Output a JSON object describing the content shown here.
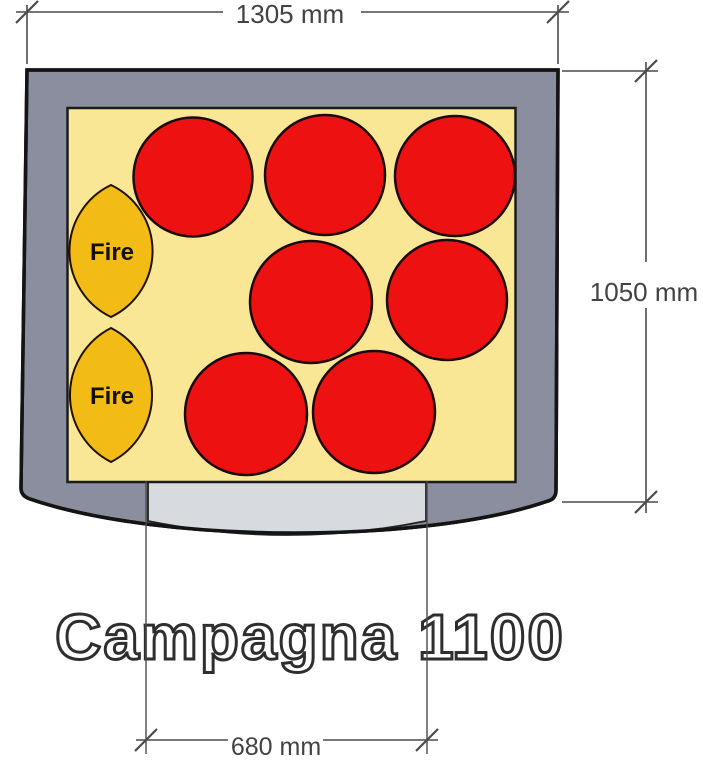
{
  "title": "Campagna 1100",
  "dimensions": {
    "width": "1305 mm",
    "depth": "1050 mm",
    "opening": "680 mm"
  },
  "oven": {
    "fire_label": "Fire",
    "pizza_count": 7,
    "pizzas": [
      {
        "cx": 193,
        "cy": 177,
        "r": 59.5
      },
      {
        "cx": 325,
        "cy": 175,
        "r": 60
      },
      {
        "cx": 455,
        "cy": 176,
        "r": 60
      },
      {
        "cx": 311,
        "cy": 302,
        "r": 61
      },
      {
        "cx": 447,
        "cy": 300,
        "r": 60
      },
      {
        "cx": 246,
        "cy": 414,
        "r": 61
      },
      {
        "cx": 374,
        "cy": 412,
        "r": 61
      }
    ],
    "flames": [
      {
        "cx": 111,
        "cy": 251,
        "rx": 41.5,
        "ry": 66
      },
      {
        "cx": 111,
        "cy": 395,
        "rx": 41,
        "ry": 67
      }
    ]
  },
  "colors": {
    "body": "#8A8E9E",
    "opening_strip": "#D7DADF",
    "floor": "#FAE795",
    "pizza": "#EE1111",
    "flame": "#F3BB15",
    "outline": "#141414",
    "dimension": "#4A4A4A",
    "label_text": "#424242"
  }
}
